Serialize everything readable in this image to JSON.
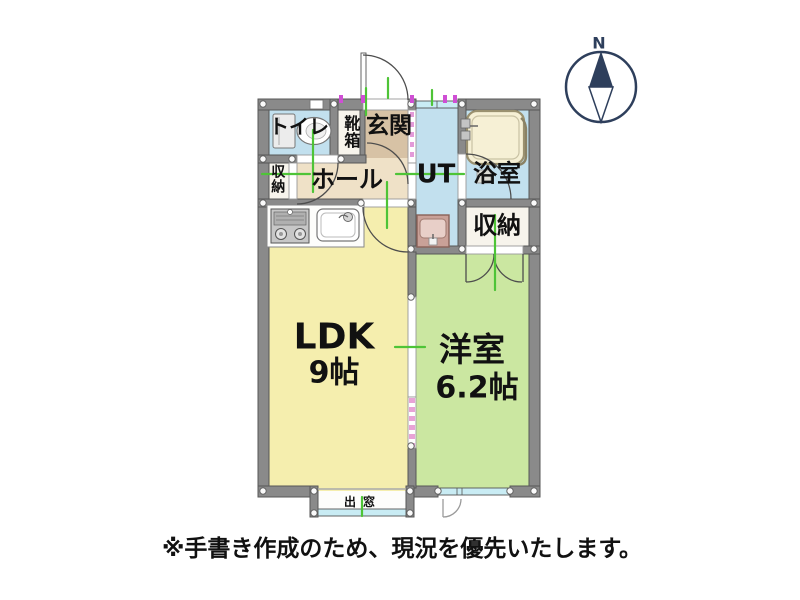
{
  "floorplan": {
    "rooms": {
      "toilet": "トイレ",
      "shoe_cabinet": "靴箱",
      "entrance": "玄関",
      "storage_left": "収納",
      "hall": "ホール",
      "utility": "UT",
      "bathroom": "浴室",
      "storage_right": "収納",
      "ldk_name": "LDK",
      "ldk_size": "9帖",
      "western_room_name": "洋室",
      "western_room_size": "6.2帖",
      "bay_window": "出窓"
    },
    "compass": {
      "label": "N",
      "color": "#2e3f5c"
    },
    "note": "※手書き作成のため、現況を優先いたします。",
    "icons": [
      "compass-icon",
      "toilet-icon",
      "bathtub-icon",
      "washbasin-icon",
      "kitchen-stove-icon",
      "kitchen-sink-icon"
    ],
    "colors": {
      "wall": "#8a8a8a",
      "wall_edge": "#575757",
      "ldk_floor": "#f5eeae",
      "western_floor": "#cbe7a1",
      "wet_floor": "#c2e0ee",
      "entrance_floor": "#d7c2a5",
      "hall_floor": "#efe1c7",
      "closet_floor": "#f7f4ec",
      "window": "#c9ecf4",
      "measure_line": "#4ec437",
      "marker": "#cf4fd4",
      "slide_door": "#e8a3d6",
      "bathtub": "#f6f0d5",
      "compass": "#2e3f5c"
    }
  }
}
